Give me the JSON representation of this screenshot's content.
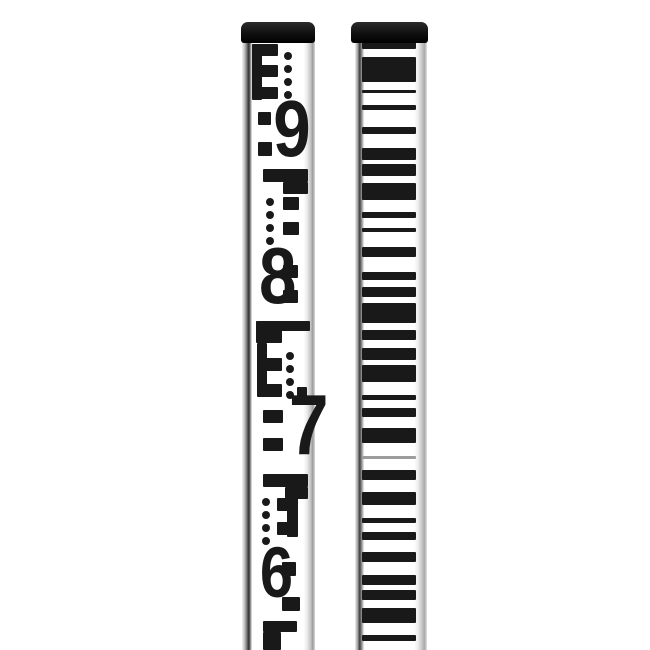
{
  "colors": {
    "background": "#ffffff",
    "ink": "#191919",
    "cap": "#121212",
    "light_stripe": "#9c9c9c"
  },
  "left_rod": {
    "kind": "e-pattern-graduation-face",
    "digits_visible": [
      "9",
      "8",
      "7",
      "6"
    ],
    "marks": [
      {
        "type": "rect",
        "x": 11,
        "y": 22,
        "w": 10,
        "h": 56
      },
      {
        "type": "rect",
        "x": 11,
        "y": 22,
        "w": 26,
        "h": 12
      },
      {
        "type": "rect",
        "x": 11,
        "y": 43,
        "w": 26,
        "h": 12
      },
      {
        "type": "rect",
        "x": 11,
        "y": 65,
        "w": 26,
        "h": 12
      },
      {
        "type": "dots",
        "cx": 47,
        "y0": 30,
        "gap": 13,
        "n": 4,
        "r": 4
      },
      {
        "type": "rect",
        "x": 17,
        "y": 90,
        "w": 13,
        "h": 13
      },
      {
        "type": "rect",
        "x": 17,
        "y": 120,
        "w": 14,
        "h": 14
      },
      {
        "type": "digit",
        "char": "9",
        "x": 30,
        "y": 76,
        "w": 28,
        "h": 62
      },
      {
        "type": "rect",
        "x": 22,
        "y": 147,
        "w": 45,
        "h": 13
      },
      {
        "type": "rect",
        "x": 42,
        "y": 160,
        "w": 25,
        "h": 12
      },
      {
        "type": "dots",
        "cx": 29,
        "y0": 176,
        "gap": 13,
        "n": 4,
        "r": 4
      },
      {
        "type": "rect",
        "x": 42,
        "y": 175,
        "w": 16,
        "h": 13
      },
      {
        "type": "rect",
        "x": 42,
        "y": 200,
        "w": 16,
        "h": 13
      },
      {
        "type": "digit",
        "char": "8",
        "x": 16,
        "y": 223,
        "w": 25,
        "h": 62
      },
      {
        "type": "rect",
        "x": 42,
        "y": 243,
        "w": 15,
        "h": 13
      },
      {
        "type": "rect",
        "x": 42,
        "y": 268,
        "w": 15,
        "h": 13
      },
      {
        "type": "rect",
        "x": 15,
        "y": 299,
        "w": 54,
        "h": 10
      },
      {
        "type": "rect",
        "x": 15,
        "y": 299,
        "w": 26,
        "h": 22
      },
      {
        "type": "rect",
        "x": 16,
        "y": 321,
        "w": 10,
        "h": 53
      },
      {
        "type": "rect",
        "x": 16,
        "y": 336,
        "w": 25,
        "h": 13
      },
      {
        "type": "rect",
        "x": 16,
        "y": 362,
        "w": 25,
        "h": 13
      },
      {
        "type": "dots",
        "cx": 49,
        "y0": 330,
        "gap": 13,
        "n": 4,
        "r": 4
      },
      {
        "type": "rect",
        "x": 56,
        "y": 365,
        "w": 10,
        "h": 10
      },
      {
        "type": "digit",
        "char": "7",
        "x": 46,
        "y": 371,
        "w": 24,
        "h": 66
      },
      {
        "type": "rect",
        "x": 22,
        "y": 388,
        "w": 20,
        "h": 13
      },
      {
        "type": "rect",
        "x": 22,
        "y": 416,
        "w": 20,
        "h": 13
      },
      {
        "type": "rect",
        "x": 22,
        "y": 452,
        "w": 45,
        "h": 13
      },
      {
        "type": "rect",
        "x": 44,
        "y": 465,
        "w": 23,
        "h": 12
      },
      {
        "type": "dots",
        "cx": 25,
        "y0": 476,
        "gap": 13,
        "n": 4,
        "r": 4
      },
      {
        "type": "rect",
        "x": 36,
        "y": 476,
        "w": 11,
        "h": 13
      },
      {
        "type": "rect",
        "x": 36,
        "y": 500,
        "w": 11,
        "h": 13
      },
      {
        "type": "rect",
        "x": 46,
        "y": 474,
        "w": 11,
        "h": 41
      },
      {
        "type": "digit",
        "char": "6",
        "x": 17,
        "y": 524,
        "w": 24,
        "h": 55
      },
      {
        "type": "rect",
        "x": 41,
        "y": 540,
        "w": 14,
        "h": 14
      },
      {
        "type": "rect",
        "x": 41,
        "y": 575,
        "w": 18,
        "h": 14
      },
      {
        "type": "rect",
        "x": 22,
        "y": 599,
        "w": 34,
        "h": 11
      },
      {
        "type": "rect",
        "x": 22,
        "y": 610,
        "w": 18,
        "h": 18
      }
    ]
  },
  "right_rod": {
    "kind": "barcode-graduation-face",
    "stripe_left": 11,
    "stripe_width": 54,
    "stripes": [
      {
        "y": 20,
        "h": 7
      },
      {
        "y": 35,
        "h": 25
      },
      {
        "y": 68,
        "h": 3
      },
      {
        "y": 83,
        "h": 5
      },
      {
        "y": 105,
        "h": 7
      },
      {
        "y": 126,
        "h": 12
      },
      {
        "y": 142,
        "h": 12
      },
      {
        "y": 161,
        "h": 17
      },
      {
        "y": 190,
        "h": 6
      },
      {
        "y": 206,
        "h": 4
      },
      {
        "y": 225,
        "h": 10
      },
      {
        "y": 250,
        "h": 8
      },
      {
        "y": 265,
        "h": 10
      },
      {
        "y": 281,
        "h": 20
      },
      {
        "y": 308,
        "h": 10
      },
      {
        "y": 326,
        "h": 12
      },
      {
        "y": 343,
        "h": 17
      },
      {
        "y": 373,
        "h": 5
      },
      {
        "y": 386,
        "h": 9
      },
      {
        "y": 406,
        "h": 15
      },
      {
        "y": 434,
        "h": 3,
        "light": true
      },
      {
        "y": 448,
        "h": 10
      },
      {
        "y": 470,
        "h": 13
      },
      {
        "y": 496,
        "h": 5
      },
      {
        "y": 510,
        "h": 8
      },
      {
        "y": 530,
        "h": 10
      },
      {
        "y": 553,
        "h": 10
      },
      {
        "y": 568,
        "h": 10
      },
      {
        "y": 586,
        "h": 15
      },
      {
        "y": 613,
        "h": 6
      }
    ]
  }
}
